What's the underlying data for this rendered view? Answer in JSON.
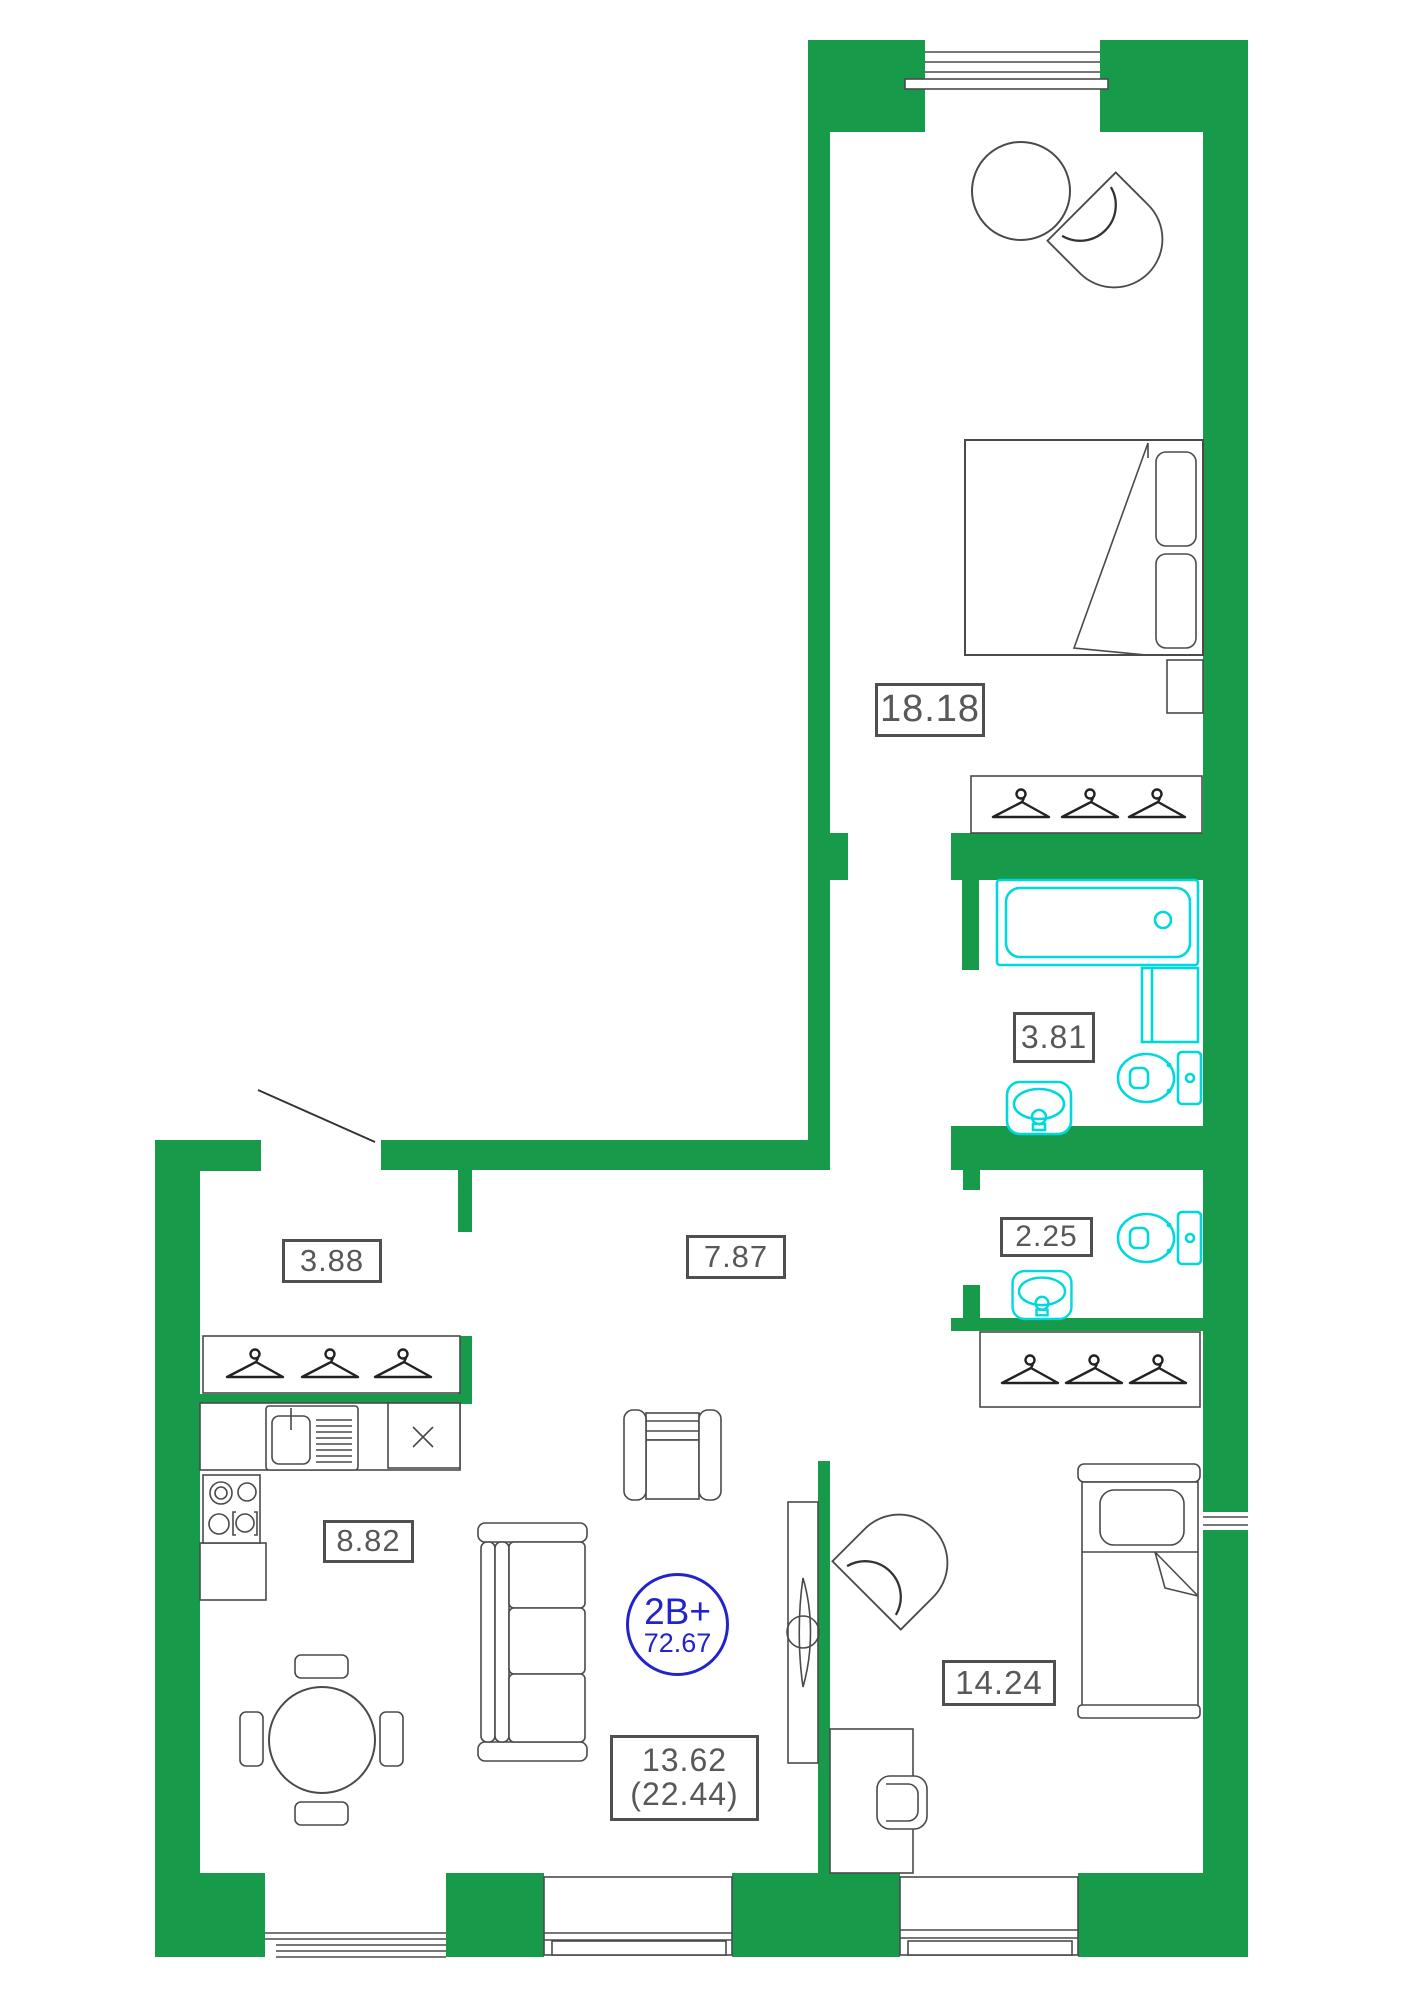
{
  "plan": {
    "title": "apartment-floor-plan",
    "unit_badge": {
      "type_label": "2B+",
      "total_area": "72.67"
    },
    "colors": {
      "wall": "#179b4a",
      "fixture": "#00d8dc",
      "badge": "#2323cd",
      "label_text": "#585858"
    },
    "rooms": [
      {
        "id": "bedroom",
        "area_label": "18.18"
      },
      {
        "id": "bathroom",
        "area_label": "3.81"
      },
      {
        "id": "wc",
        "area_label": "2.25"
      },
      {
        "id": "hall-closet",
        "area_label": "3.88"
      },
      {
        "id": "corridor",
        "area_label": "7.87"
      },
      {
        "id": "kitchen",
        "area_label": "8.82"
      },
      {
        "id": "child-bedroom",
        "area_label": "14.24"
      },
      {
        "id": "living-room",
        "area_label": "13.62",
        "area_label_secondary": "(22.44)"
      }
    ]
  }
}
